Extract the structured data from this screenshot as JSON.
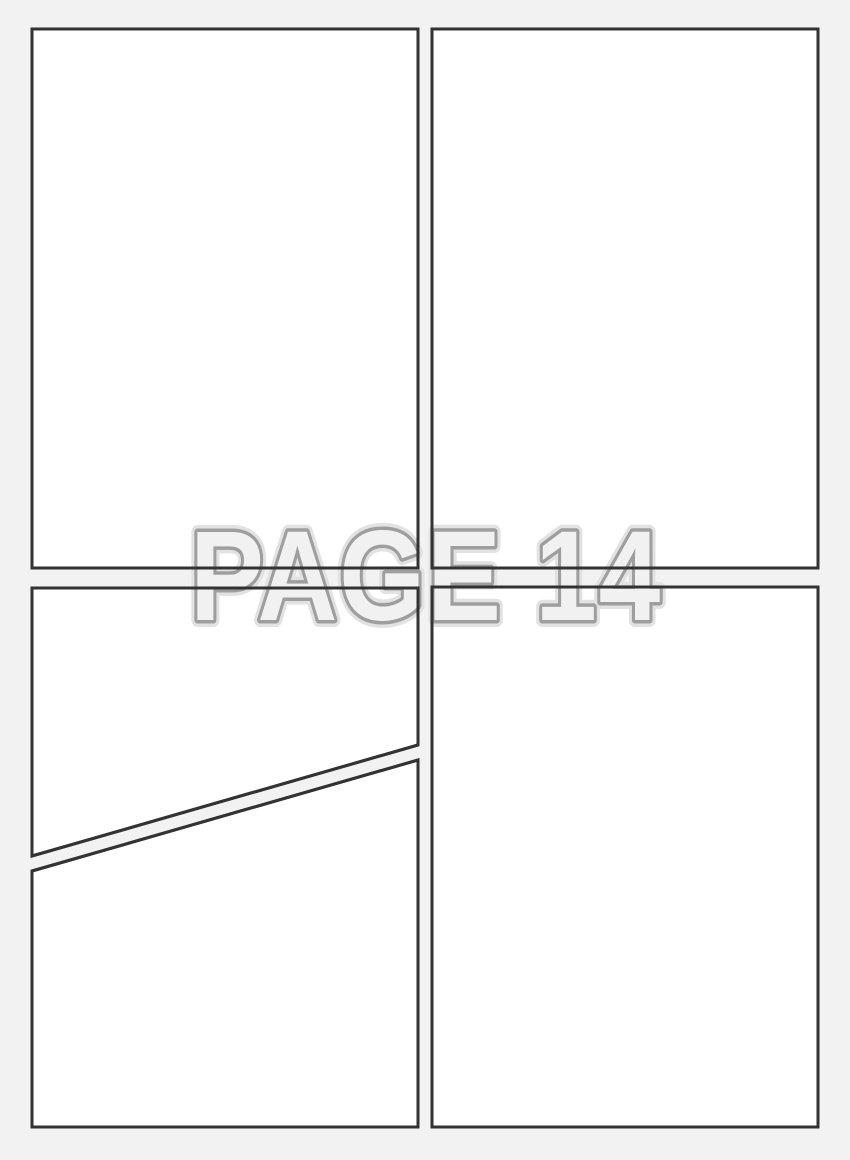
{
  "page": {
    "watermark_label": "PAGE 14",
    "colors": {
      "background": "#f2f2f2",
      "panel_fill": "#ffffff",
      "panel_border": "#333333",
      "label_fill": "#f1f1f1",
      "label_outline": "#9e9e9e",
      "label_halo": "#e2e2e2"
    },
    "panels": [
      {
        "id": "top-left",
        "shape": "rectangle"
      },
      {
        "id": "top-right",
        "shape": "rectangle"
      },
      {
        "id": "bottom-left-upper",
        "shape": "rectangle-with-diagonal-bottom-edge"
      },
      {
        "id": "bottom-left-lower",
        "shape": "rectangle-with-diagonal-top-edge"
      },
      {
        "id": "bottom-right",
        "shape": "rectangle"
      }
    ]
  }
}
